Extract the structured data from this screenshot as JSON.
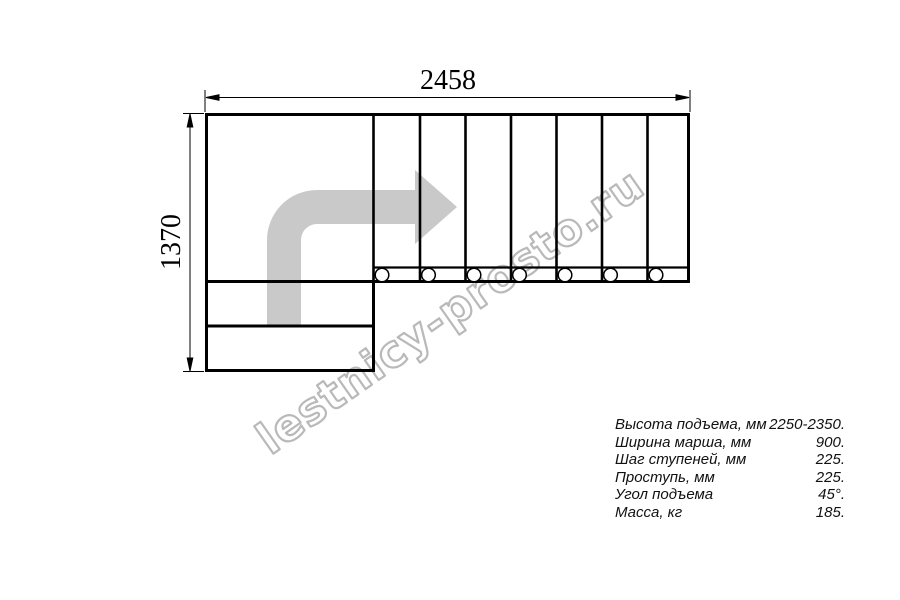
{
  "drawing": {
    "top_dimension": "2458",
    "left_dimension": "1370",
    "riser_count": 7,
    "baluster_count": 7
  },
  "watermark": {
    "text": "lestnicy-prosto.ru"
  },
  "specs": {
    "rows": [
      {
        "label": "Высота подъема, мм",
        "value": "2250-2350."
      },
      {
        "label": "Ширина марша, мм",
        "value": "900."
      },
      {
        "label": "Шаг ступеней, мм",
        "value": "225."
      },
      {
        "label": "Проступь, мм",
        "value": "225."
      },
      {
        "label": "Угол подъема",
        "value": "45°."
      },
      {
        "label": "Масса, кг",
        "value": "185."
      }
    ]
  },
  "colors": {
    "line": "#000000",
    "arrow_fill": "#c9c9c9",
    "watermark": "#b9b9b9",
    "background": "#ffffff"
  }
}
